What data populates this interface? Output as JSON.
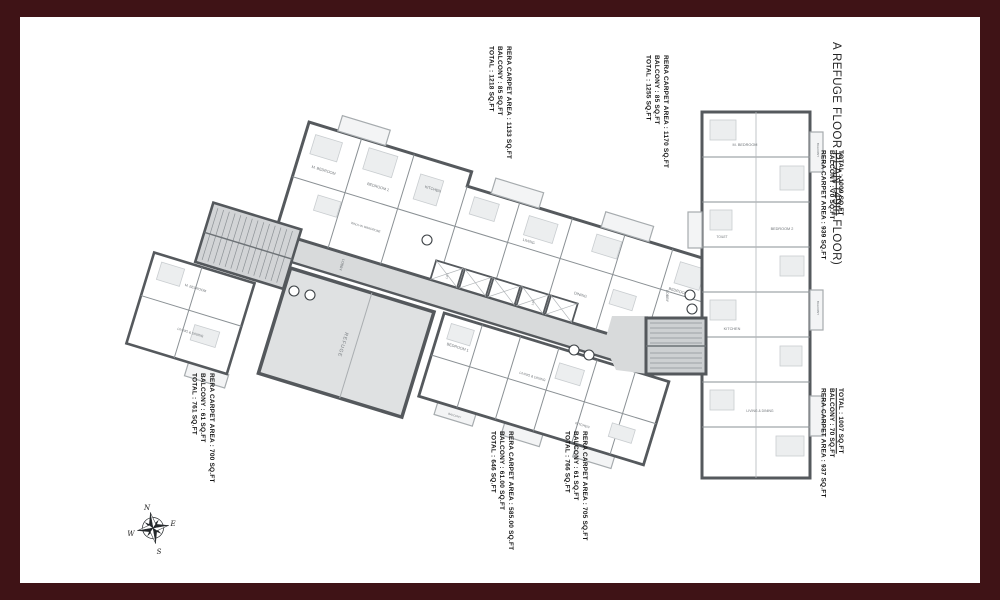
{
  "title": "A REFUGE FLOOR PLAN (49th FLOOR)",
  "units": [
    {
      "carpet_area": "RERA CARPET AREA : 1133 SQ.FT",
      "balcony": "BALCONY : 85 SQ.FT",
      "total": "TOTAL : 1218 SQ.FT"
    },
    {
      "carpet_area": "RERA CARPET AREA : 1170 SQ.FT",
      "balcony": "BALCONY : 85 SQ.FT",
      "total": "TOTAL : 1255 SQ.FT"
    },
    {
      "carpet_area": "RERA CARPET AREA : 939 SQ.FT",
      "balcony": "BALCONY : 70 SQ.FT",
      "total": "TOTAL : 1009 SQ.FT"
    },
    {
      "carpet_area": "RERA CARPET AREA : 937 SQ.FT",
      "balcony": "BALCONY : 70 SQ.FT",
      "total": "TOTAL : 1007 SQ.FT"
    },
    {
      "carpet_area": "RERA CARPET AREA : 700 SQ.FT",
      "balcony": "BALCONY : 61 SQ.FT",
      "total": "TOTAL : 761 SQ.FT"
    },
    {
      "carpet_area": "RERA CARPET AREA : 585.00 SQ.FT",
      "balcony": "BALCONY : 61.00 SQ.FT",
      "total": "TOTAL : 646 SQ.FT"
    },
    {
      "carpet_area": "RERA CARPET AREA : 705 SQ.FT",
      "balcony": "BALCONY : 61 SQ.FT",
      "total": "TOTAL : 766 SQ.FT"
    }
  ],
  "rooms": [
    "LOBBY",
    "LIFT",
    "M. BEDROOM",
    "BEDROOM 1",
    "BEDROOM 2",
    "KITCHEN",
    "LIVING",
    "DINING",
    "LIVING & DINING",
    "BALCONY",
    "TOILET",
    "M. TOILET",
    "PASS",
    "REFUGE",
    "WALK-IN WARDROBE"
  ],
  "compass": {
    "n": "N",
    "e": "E",
    "s": "S",
    "w": "W"
  },
  "colors": {
    "frame_border": "#3F1316",
    "wall": "#55595d",
    "corridor_fill": "#d8dadb",
    "stair_fill": "#cdd0d2",
    "refuge_fill": "#dfe1e2",
    "balcony_fill": "#f3f4f5",
    "paper": "#ffffff"
  }
}
